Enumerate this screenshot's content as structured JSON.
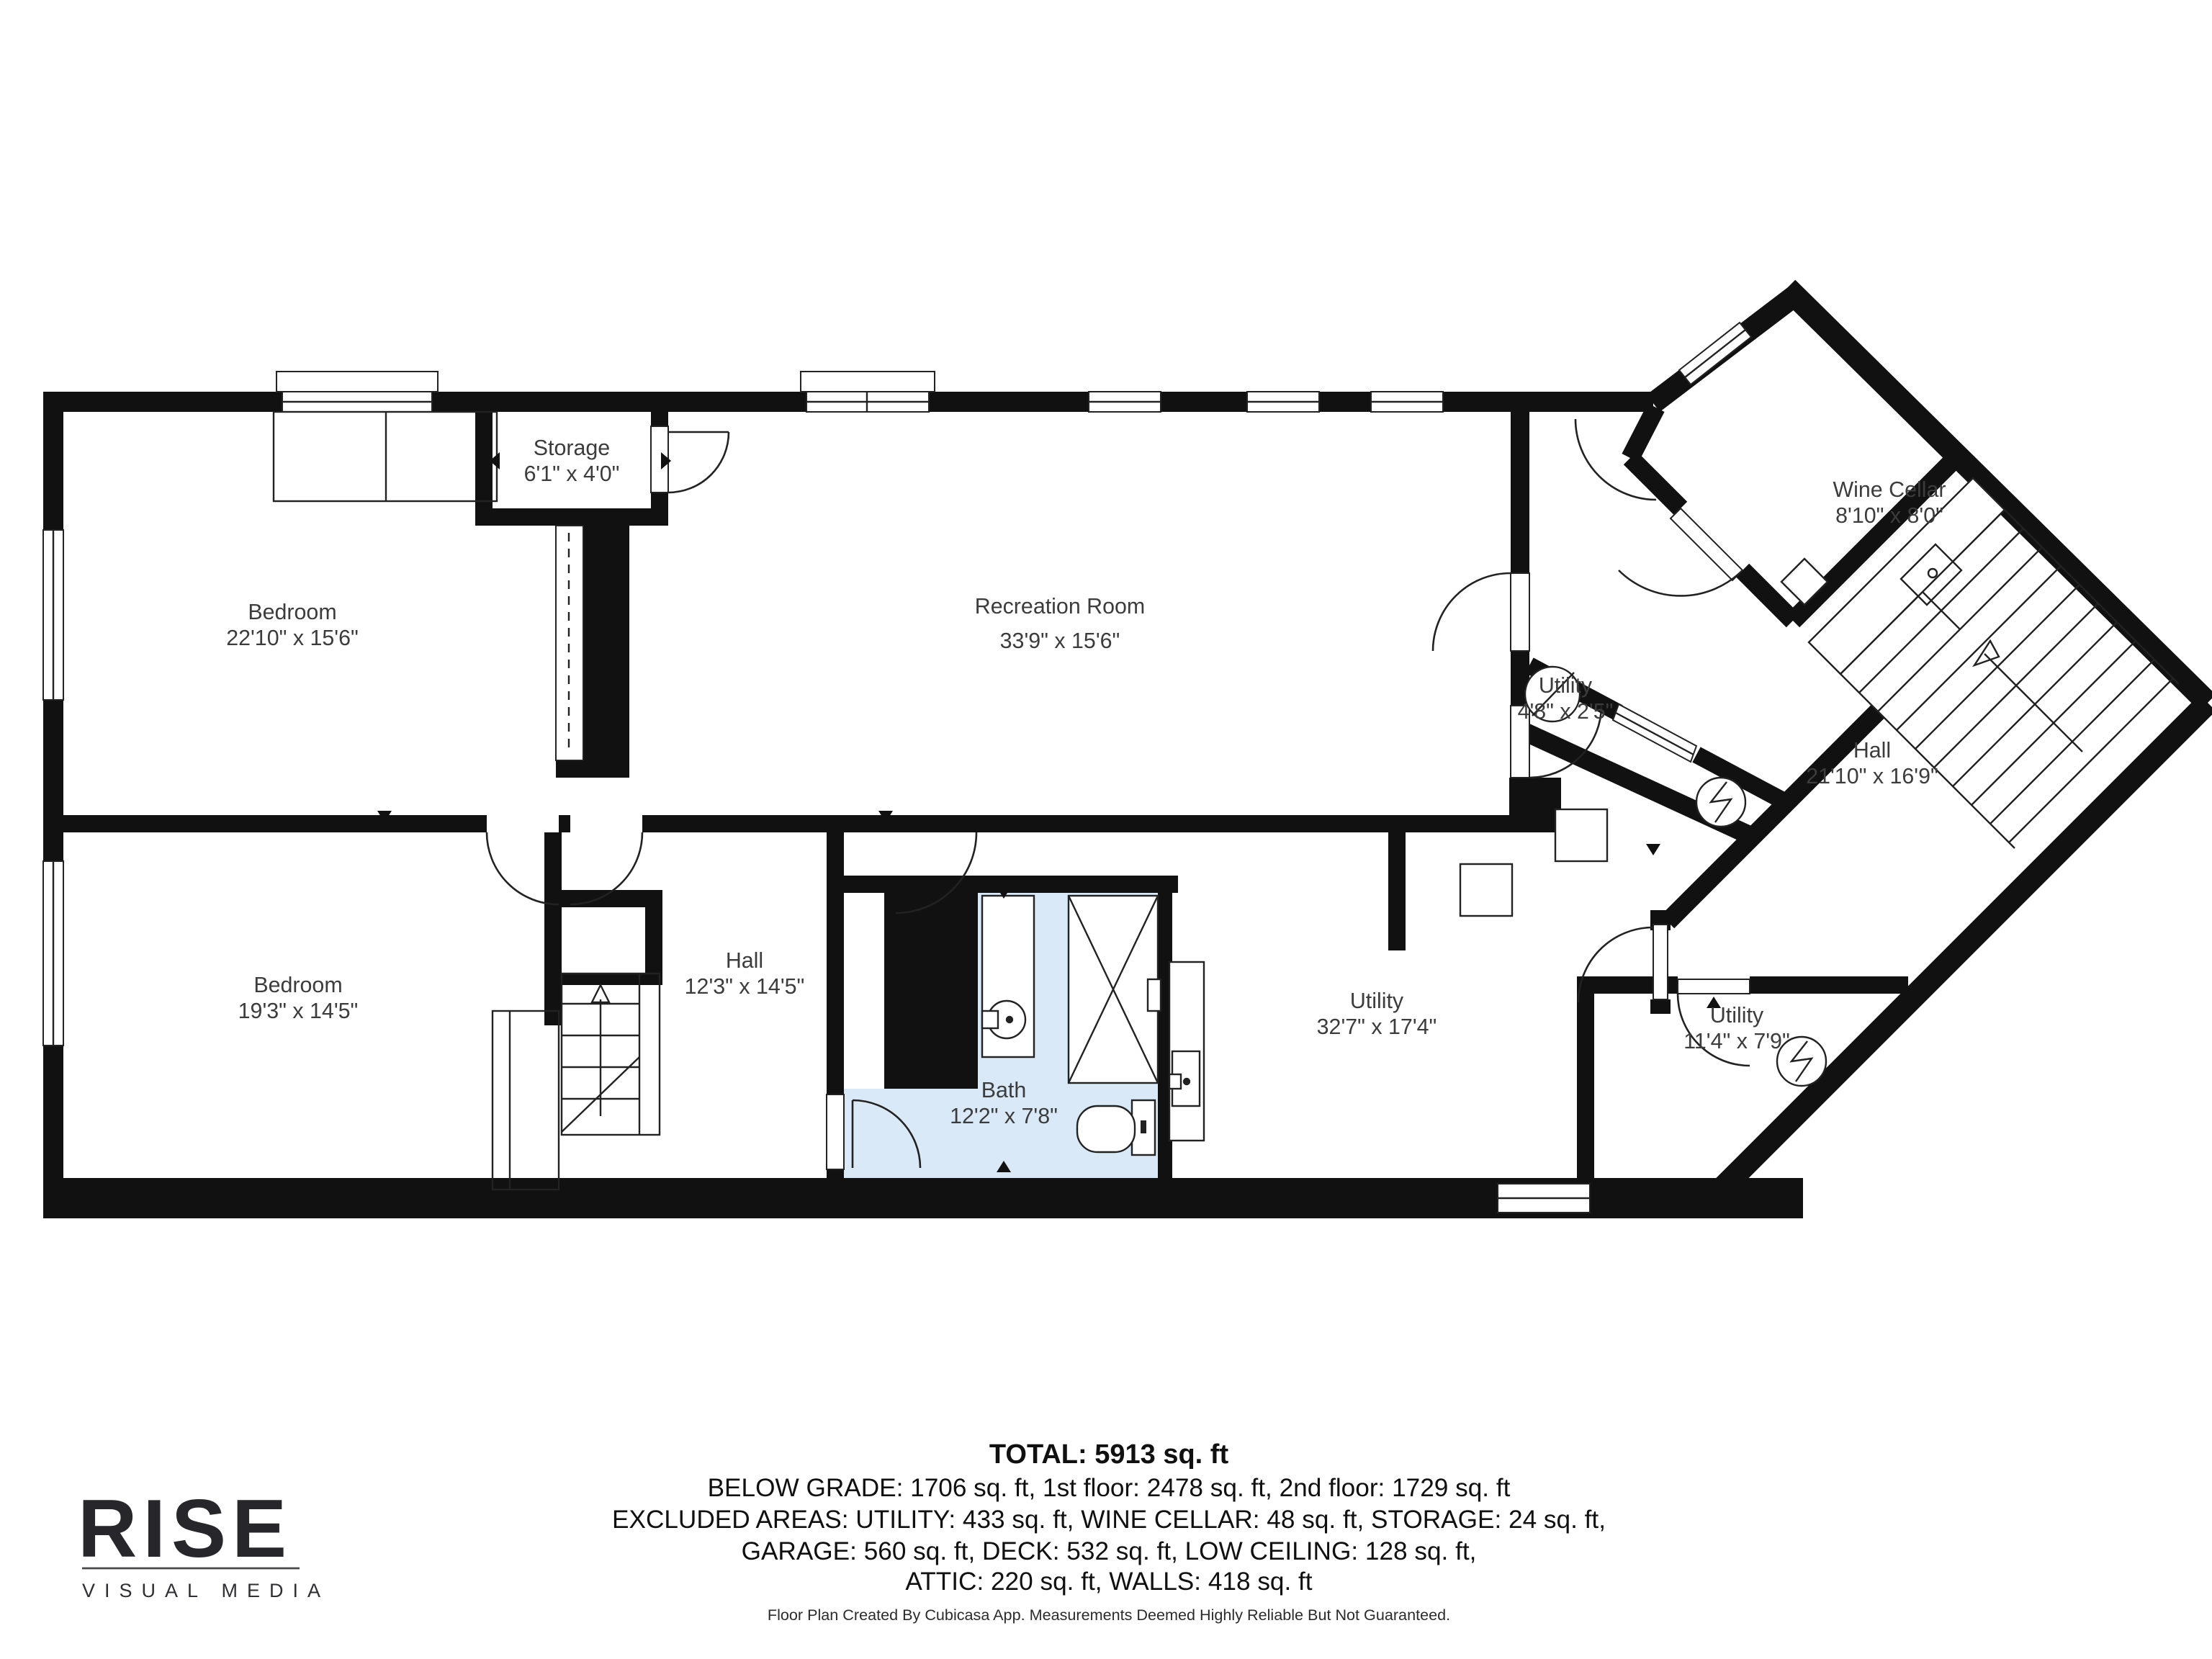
{
  "title": "Below grade floor plan",
  "colors": {
    "wall": "#111111",
    "bath_fill": "#d9e9f7",
    "label_text": "#3c3c3c",
    "summary_text": "#101010",
    "logo_text": "#26262b",
    "background": "#ffffff"
  },
  "rooms": [
    {
      "id": "bedroom-1",
      "name": "Bedroom",
      "dims": "22'10\" x 15'6\""
    },
    {
      "id": "storage",
      "name": "Storage",
      "dims": "6'1\" x 4'0\""
    },
    {
      "id": "recreation-room",
      "name": "Recreation Room",
      "dims": "33'9\" x 15'6\""
    },
    {
      "id": "wine-cellar",
      "name": "Wine Cellar",
      "dims": "8'10\" x 8'0\""
    },
    {
      "id": "utility-small",
      "name": "Utility",
      "dims": "4'8\" x 2'5\""
    },
    {
      "id": "hall-upper",
      "name": "Hall",
      "dims": "21'10\" x 16'9\""
    },
    {
      "id": "bedroom-2",
      "name": "Bedroom",
      "dims": "19'3\" x 14'5\""
    },
    {
      "id": "hall-lower",
      "name": "Hall",
      "dims": "12'3\" x 14'5\""
    },
    {
      "id": "bath",
      "name": "Bath",
      "dims": "12'2\" x 7'8\""
    },
    {
      "id": "utility-main",
      "name": "Utility",
      "dims": "32'7\" x 17'4\""
    },
    {
      "id": "utility-right",
      "name": "Utility",
      "dims": "11'4\" x 7'9\""
    }
  ],
  "summary": {
    "total": "TOTAL: 5913 sq. ft",
    "line1": "BELOW GRADE: 1706 sq. ft, 1st floor: 2478 sq. ft, 2nd floor: 1729 sq. ft",
    "line2": "EXCLUDED AREAS: UTILITY: 433 sq. ft, WINE CELLAR: 48 sq. ft, STORAGE: 24 sq. ft,",
    "line3": "GARAGE: 560 sq. ft, DECK: 532 sq. ft, LOW CEILING: 128 sq. ft,",
    "line4": "ATTIC: 220 sq. ft, WALLS: 418 sq. ft"
  },
  "footer": {
    "disclaimer": "Floor Plan Created By Cubicasa App. Measurements Deemed Highly Reliable But Not Guaranteed."
  },
  "logo": {
    "brand": "RISE",
    "tagline": "VISUAL MEDIA"
  },
  "icons": {
    "water_heater": "circle-with-slash",
    "electrical_panel": "circle-with-lightning-bolt",
    "stairs": "parallel-treads-with-up-arrow",
    "bathroom": [
      "sink-circle",
      "shower-x-box",
      "toilet"
    ]
  }
}
